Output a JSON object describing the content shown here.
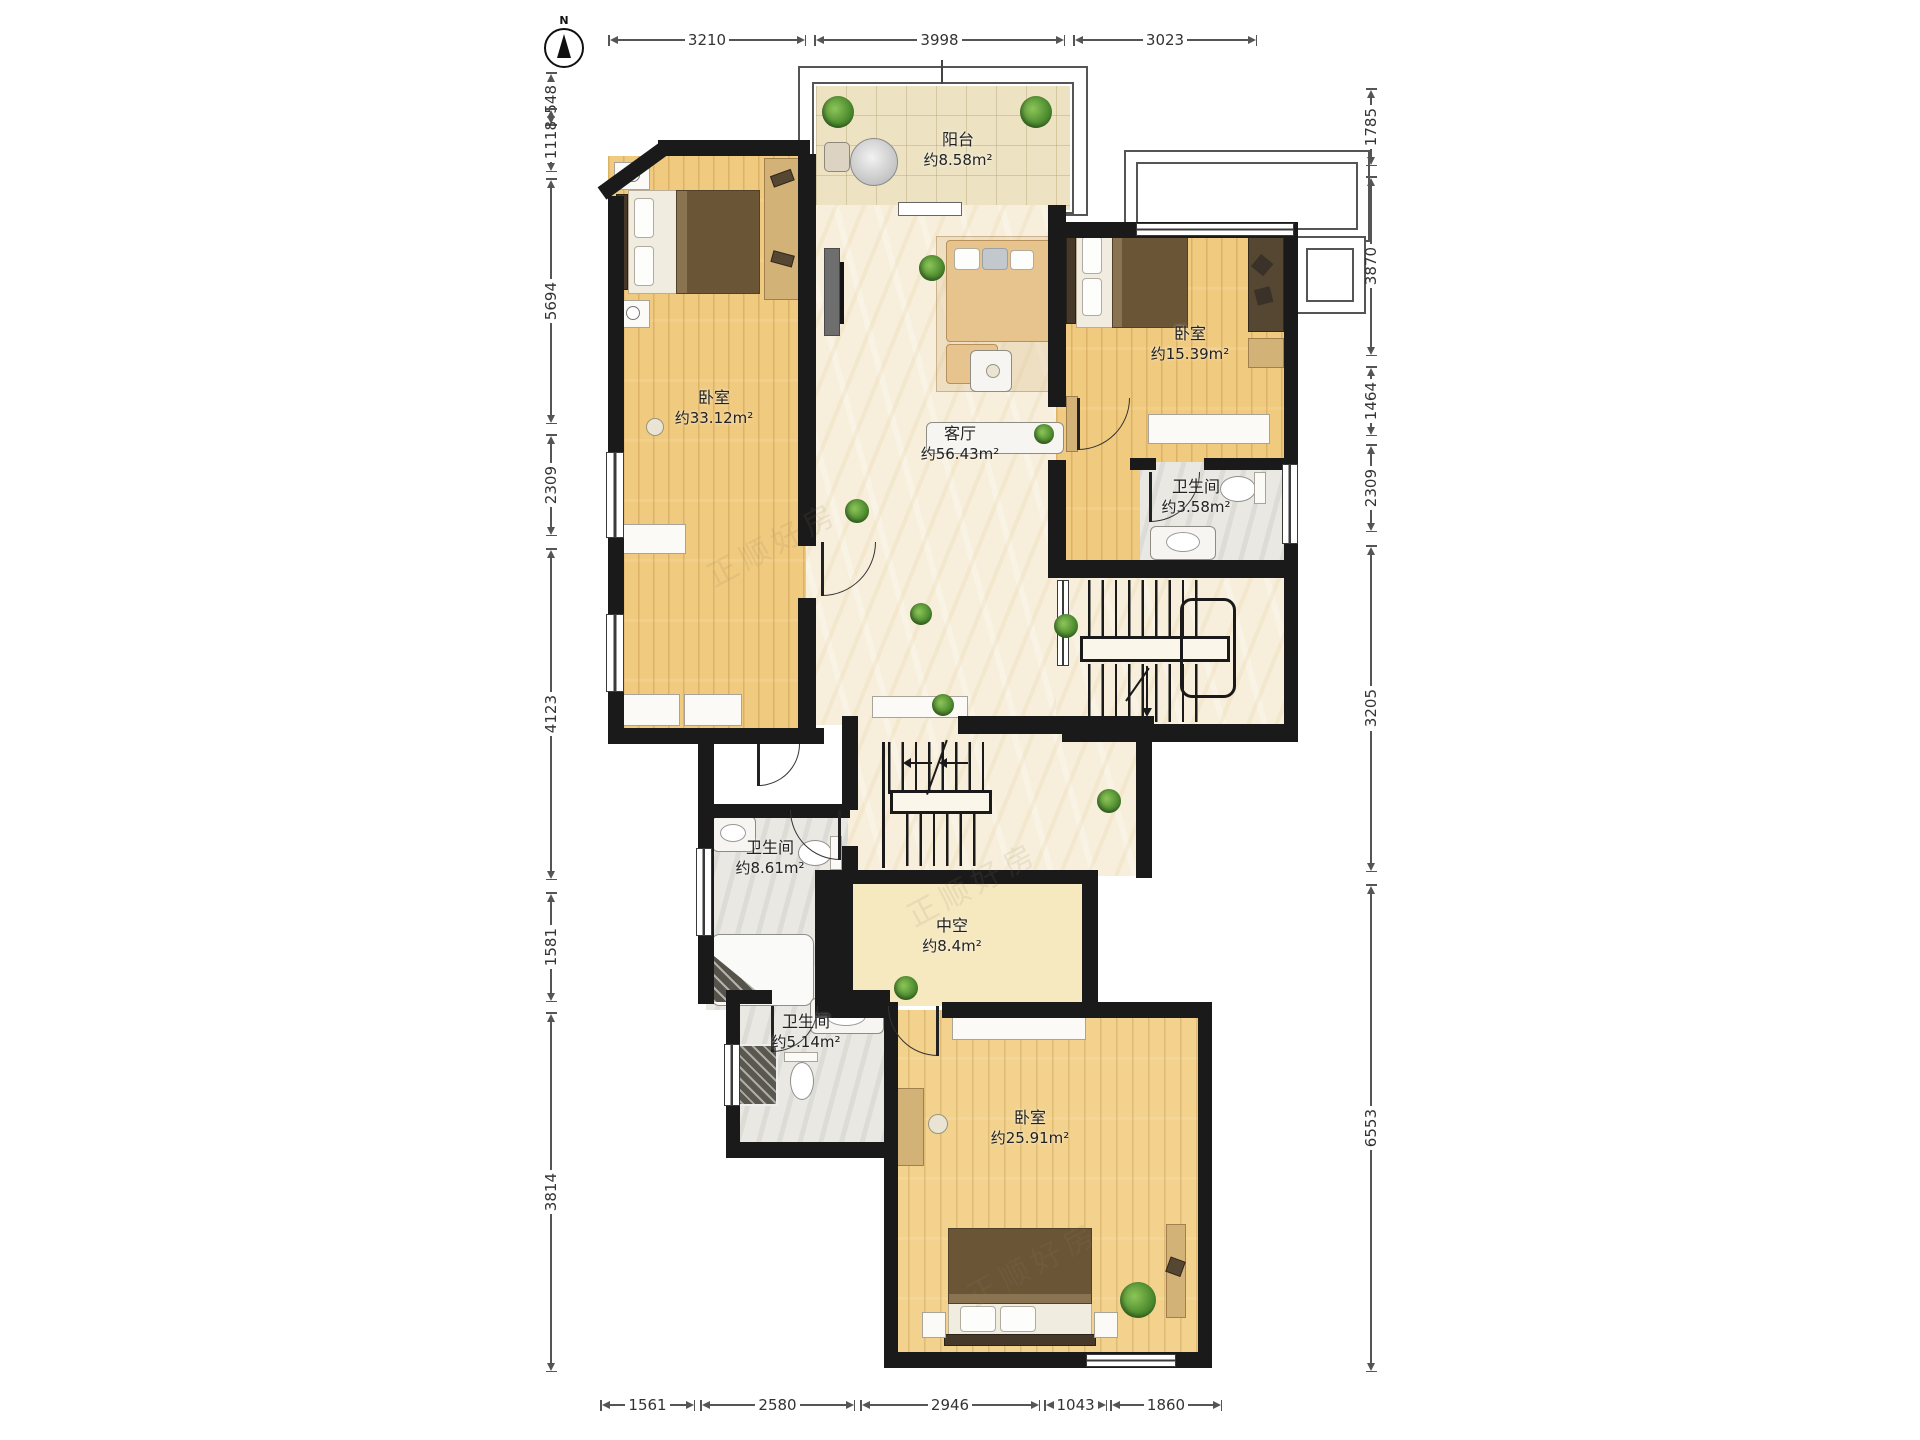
{
  "compass": {
    "label": "N"
  },
  "watermark": {
    "text": "正顺好房"
  },
  "rooms": {
    "balcony": {
      "name": "阳台",
      "area": "约8.58m²"
    },
    "bedroom_left": {
      "name": "卧室",
      "area": "约33.12m²"
    },
    "living": {
      "name": "客厅",
      "area": "约56.43m²"
    },
    "bedroom_right": {
      "name": "卧室",
      "area": "约15.39m²"
    },
    "bath_right": {
      "name": "卫生间",
      "area": "约3.58m²"
    },
    "bath_mid": {
      "name": "卫生间",
      "area": "约8.61m²"
    },
    "void": {
      "name": "中空",
      "area": "约8.4m²"
    },
    "bath_low": {
      "name": "卫生间",
      "area": "约5.14m²"
    },
    "bedroom_bottom": {
      "name": "卧室",
      "area": "约25.91m²"
    }
  },
  "dimensions": {
    "top": [
      "3210",
      "3998",
      "3023"
    ],
    "bottom": [
      "1561",
      "2580",
      "2946",
      "1043",
      "1860"
    ],
    "left": [
      "548",
      "1118",
      "5694",
      "2309",
      "4123",
      "1581",
      "3814"
    ],
    "right": [
      "1785",
      "3870",
      "1464",
      "2309",
      "3205",
      "6553"
    ]
  },
  "colors": {
    "wall": "#1a1a1a",
    "wood_floor": "#f0ca7e",
    "marble_floor": "#f7efdb",
    "tile_floor": "#ede3c3",
    "bath_floor": "#e9e8e3",
    "void_floor": "#f6e8bf",
    "plant": "#4c8a2e"
  }
}
